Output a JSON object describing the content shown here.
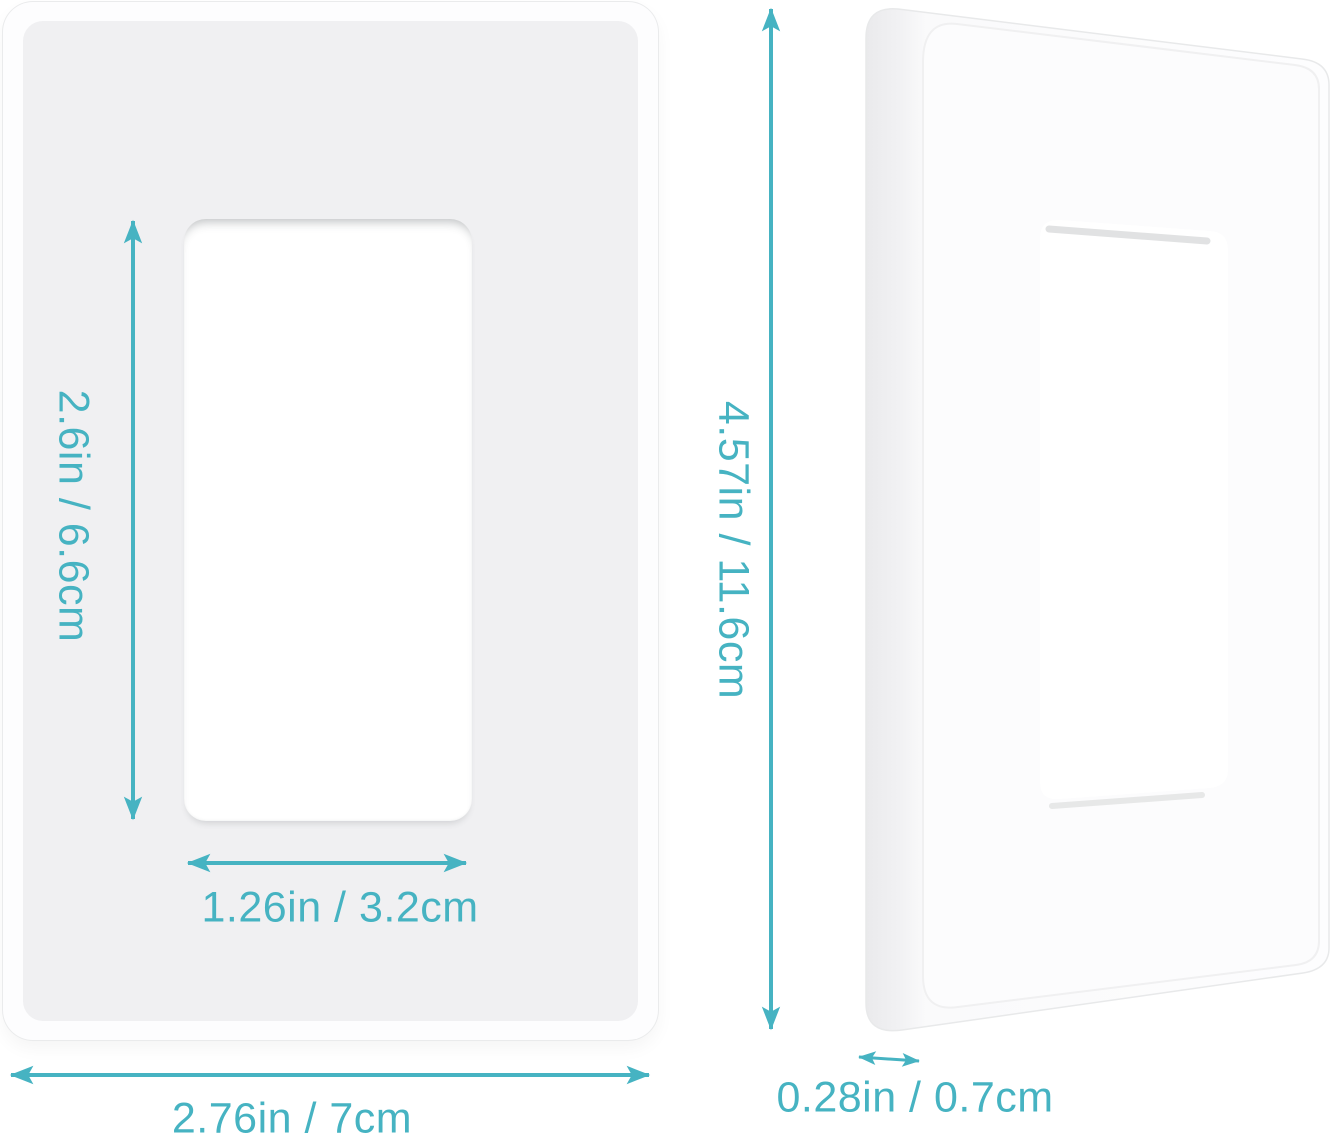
{
  "colors": {
    "accent": "#46b3c2",
    "plate_face": "#f0f0f2",
    "background": "#ffffff"
  },
  "diagram": {
    "front_view": {
      "opening_height_label": "2.6in / 6.6cm",
      "opening_width_label": "1.26in / 3.2cm",
      "plate_width_label": "2.76in / 7cm"
    },
    "side_view": {
      "plate_height_label": "4.57in / 11.6cm",
      "plate_thickness_label": "0.28in / 0.7cm"
    }
  }
}
